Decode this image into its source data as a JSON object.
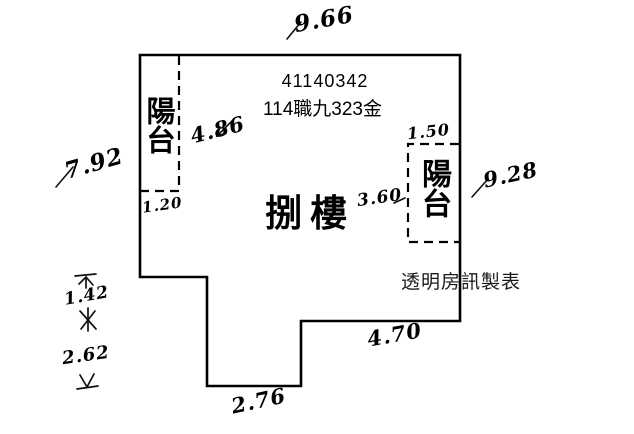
{
  "document": {
    "unit_number": "41140342",
    "case_label": "114職九323金",
    "floor_name": "捌樓",
    "credit": "透明房訊製表"
  },
  "balconies": {
    "left_label": "陽台",
    "right_label": "陽台"
  },
  "measurements": {
    "top_width": "9.66",
    "left_height": "7.92",
    "left_balcony_length": "4.86",
    "left_balcony_width": "1.20",
    "right_balcony_width": "1.50",
    "right_balcony_length": "3.60",
    "right_height": "9.28",
    "bottom_right_width": "4.70",
    "bottom_notch_width": "2.76",
    "left_notch_upper": "1.42",
    "left_notch_lower": "2.62"
  },
  "icons": {
    "dim_arrow_up": "arrow with end-bar pointing up",
    "dim_arrows_meeting": "crossed arrowheads between segments",
    "dim_arrow_down": "arrow with end-bar pointing down"
  },
  "colors": {
    "ink": "#000000",
    "paper": "#ffffff"
  }
}
